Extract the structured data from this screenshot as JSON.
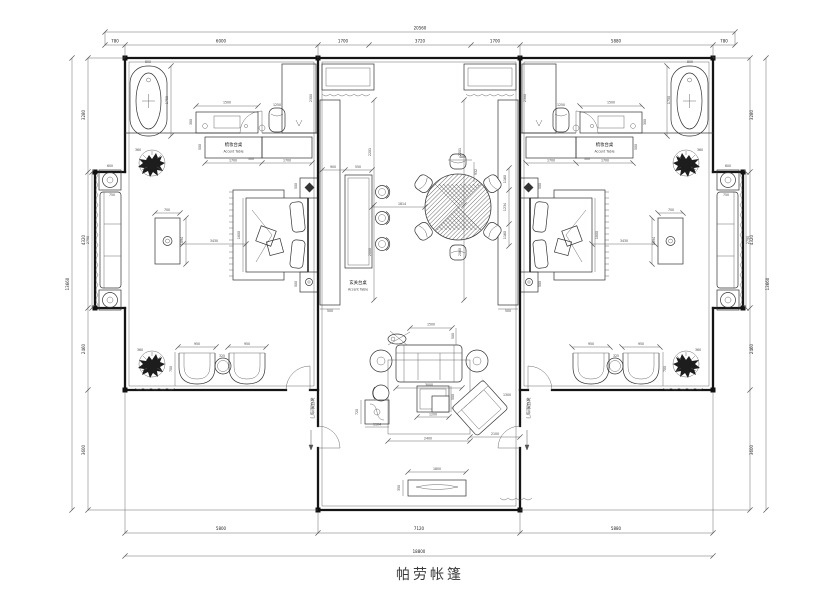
{
  "labels": {
    "title": "帕劳帐篷",
    "dresser_cn": "梳妆台桌",
    "dresser_en": "Accent Table",
    "console_cn": "玄关台桌",
    "console_en": "Accent Table",
    "door_note": "玻璃推拉门"
  },
  "d": {
    "top_overall": "20560",
    "top": [
      "780",
      "6000",
      "1700",
      "3720",
      "1700",
      "5880",
      "780"
    ],
    "bottom": [
      "5800",
      "7120",
      "5880"
    ],
    "bottom_overall": "18800",
    "side": [
      "3280",
      "4320",
      "2460",
      "3600"
    ],
    "side_overall": "13660",
    "bath_w": "800",
    "bath_l": "1750",
    "vanity": "1500",
    "vanity_d": "300",
    "stool": "1250",
    "shower_h": "2300",
    "door": "500",
    "cab_a": "1700",
    "cab_b": "1700",
    "cab_d": "500",
    "plant_a": "360",
    "plant_b": "360",
    "bay_tbl": "600",
    "bay_sofa_d": "750",
    "bay_in": "2790",
    "bed_line": "3430",
    "bed_w": "1800",
    "ns": "500",
    "tbl_sq": "700",
    "tbl_sq_h": "1094",
    "lng": "950",
    "lng_d": "700",
    "lng_tbl": "325",
    "ward_w": "500",
    "ward_h": "2201",
    "ward_h2": "2000",
    "con_off": "900",
    "con_w": "550",
    "din_link": "1814",
    "din_r": "1234",
    "din_c": "1160",
    "din_t": "480",
    "din_t2": "932",
    "sofa_top": "1500",
    "sofa_500": "500",
    "sofa_w": "3000",
    "ct": "1200",
    "ct_d": "500",
    "arm": "2100",
    "arm2": "1300",
    "rug": "2400",
    "st_d": "720",
    "st_w": "1104",
    "tv": "1800",
    "tv_d": "350"
  },
  "colors": {
    "wall": "#151515",
    "line": "#3d3d3d",
    "dim": "#6a6a6a",
    "text": "#222",
    "bg": "#ffffff"
  }
}
